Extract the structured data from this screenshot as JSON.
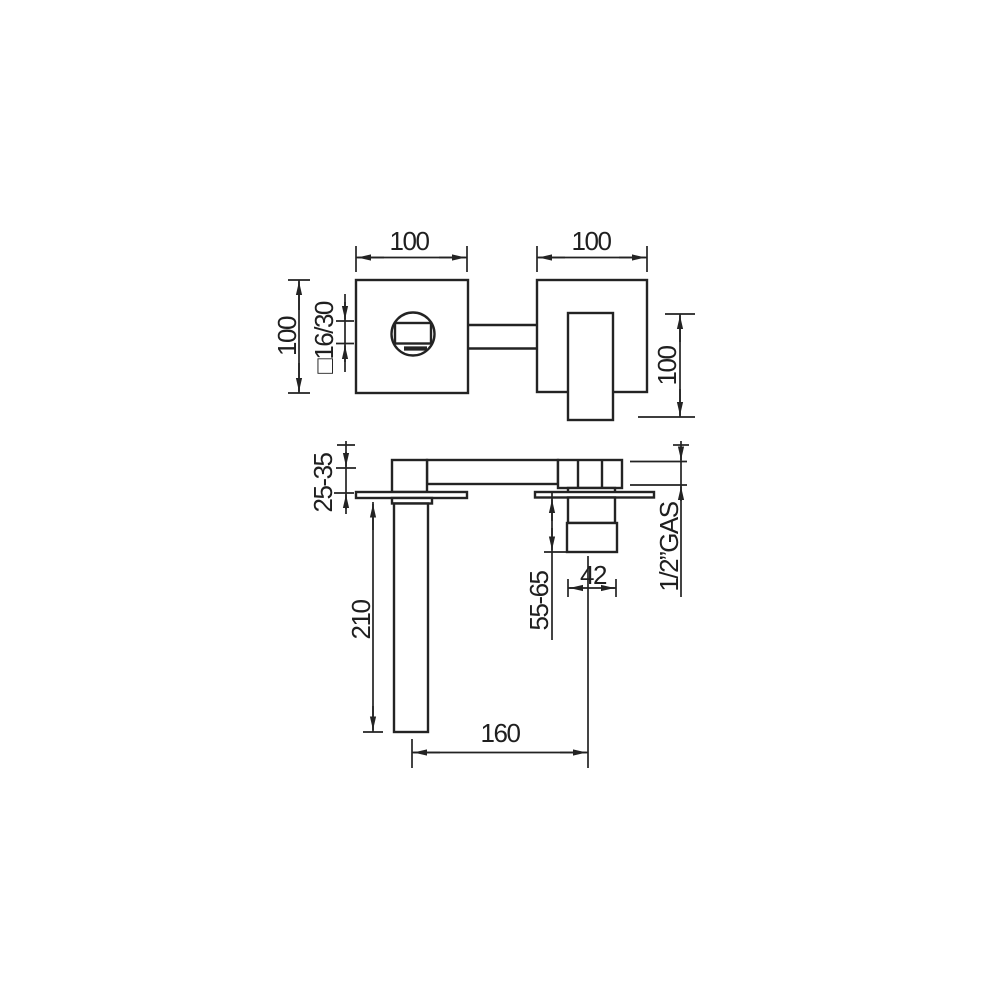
{
  "drawing": {
    "colors": {
      "line": "#232323",
      "background": "#ffffff"
    },
    "front_view": {
      "plate_width_label": "100",
      "body_width_label": "100",
      "plate_height_label": "100",
      "outlet_label": "□16/30",
      "handle_length_label": "100"
    },
    "side_view": {
      "wall_depth_label": "25-35",
      "spout_drop_label": "210",
      "valve_drop_label": "55-65",
      "handle_width_label": "42",
      "inlet_connection_label": "1/2”GAS",
      "spout_reach_label": "160"
    }
  }
}
